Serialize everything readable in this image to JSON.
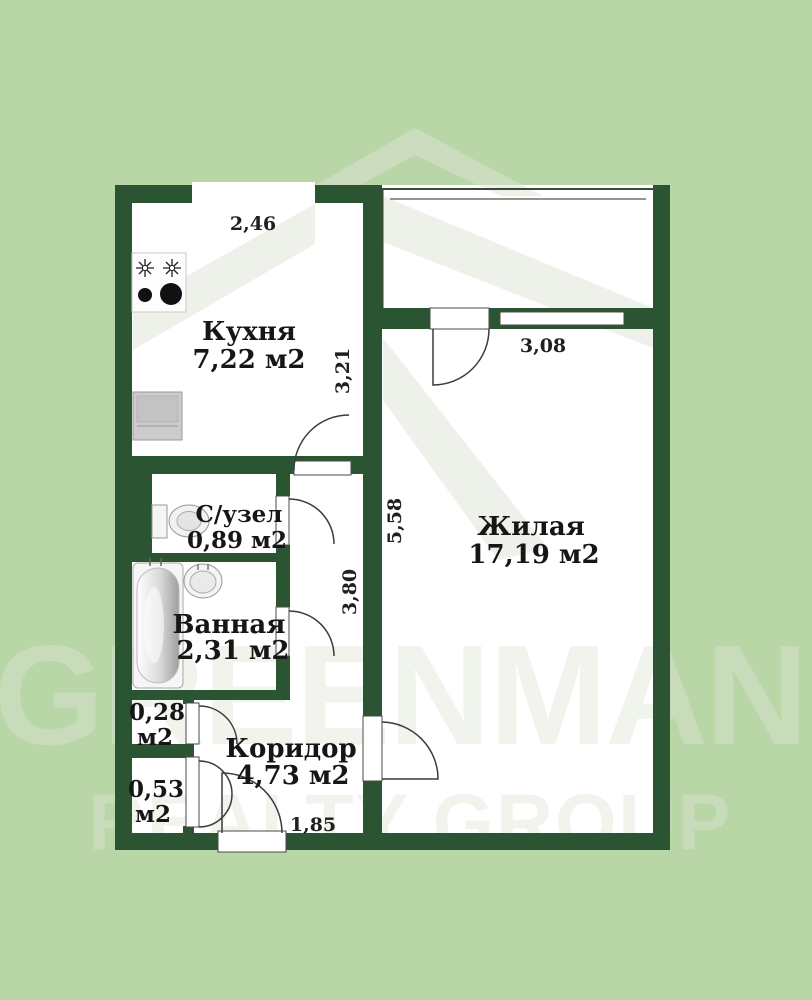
{
  "colors": {
    "background": "#b8d6a6",
    "wall": "#2b5433",
    "watermark": "#dfe4d6",
    "floor": "#ffffff"
  },
  "watermark": {
    "line1": "GREENMAN",
    "line2": "REALTY GROUP"
  },
  "rooms": {
    "kitchen": {
      "name": "Кухня",
      "area": "7,22 м2"
    },
    "toilet": {
      "name": "С/узел",
      "area": "0,89 м2"
    },
    "bathroom": {
      "name": "Ванная",
      "area": "2,31 м2"
    },
    "closet_small": {
      "name": "0,28",
      "unit": "м2"
    },
    "closet_large": {
      "name": "0,53",
      "unit": "м2"
    },
    "corridor": {
      "name": "Коридор",
      "area": "4,73 м2"
    },
    "living": {
      "name": "Жилая",
      "area": "17,19 м2"
    }
  },
  "dimensions": {
    "kitchen_width": "2,46",
    "kitchen_height": "3,21",
    "living_width": "3,08",
    "living_height": "5,58",
    "corridor_height": "3,80",
    "corridor_width": "1,85"
  }
}
